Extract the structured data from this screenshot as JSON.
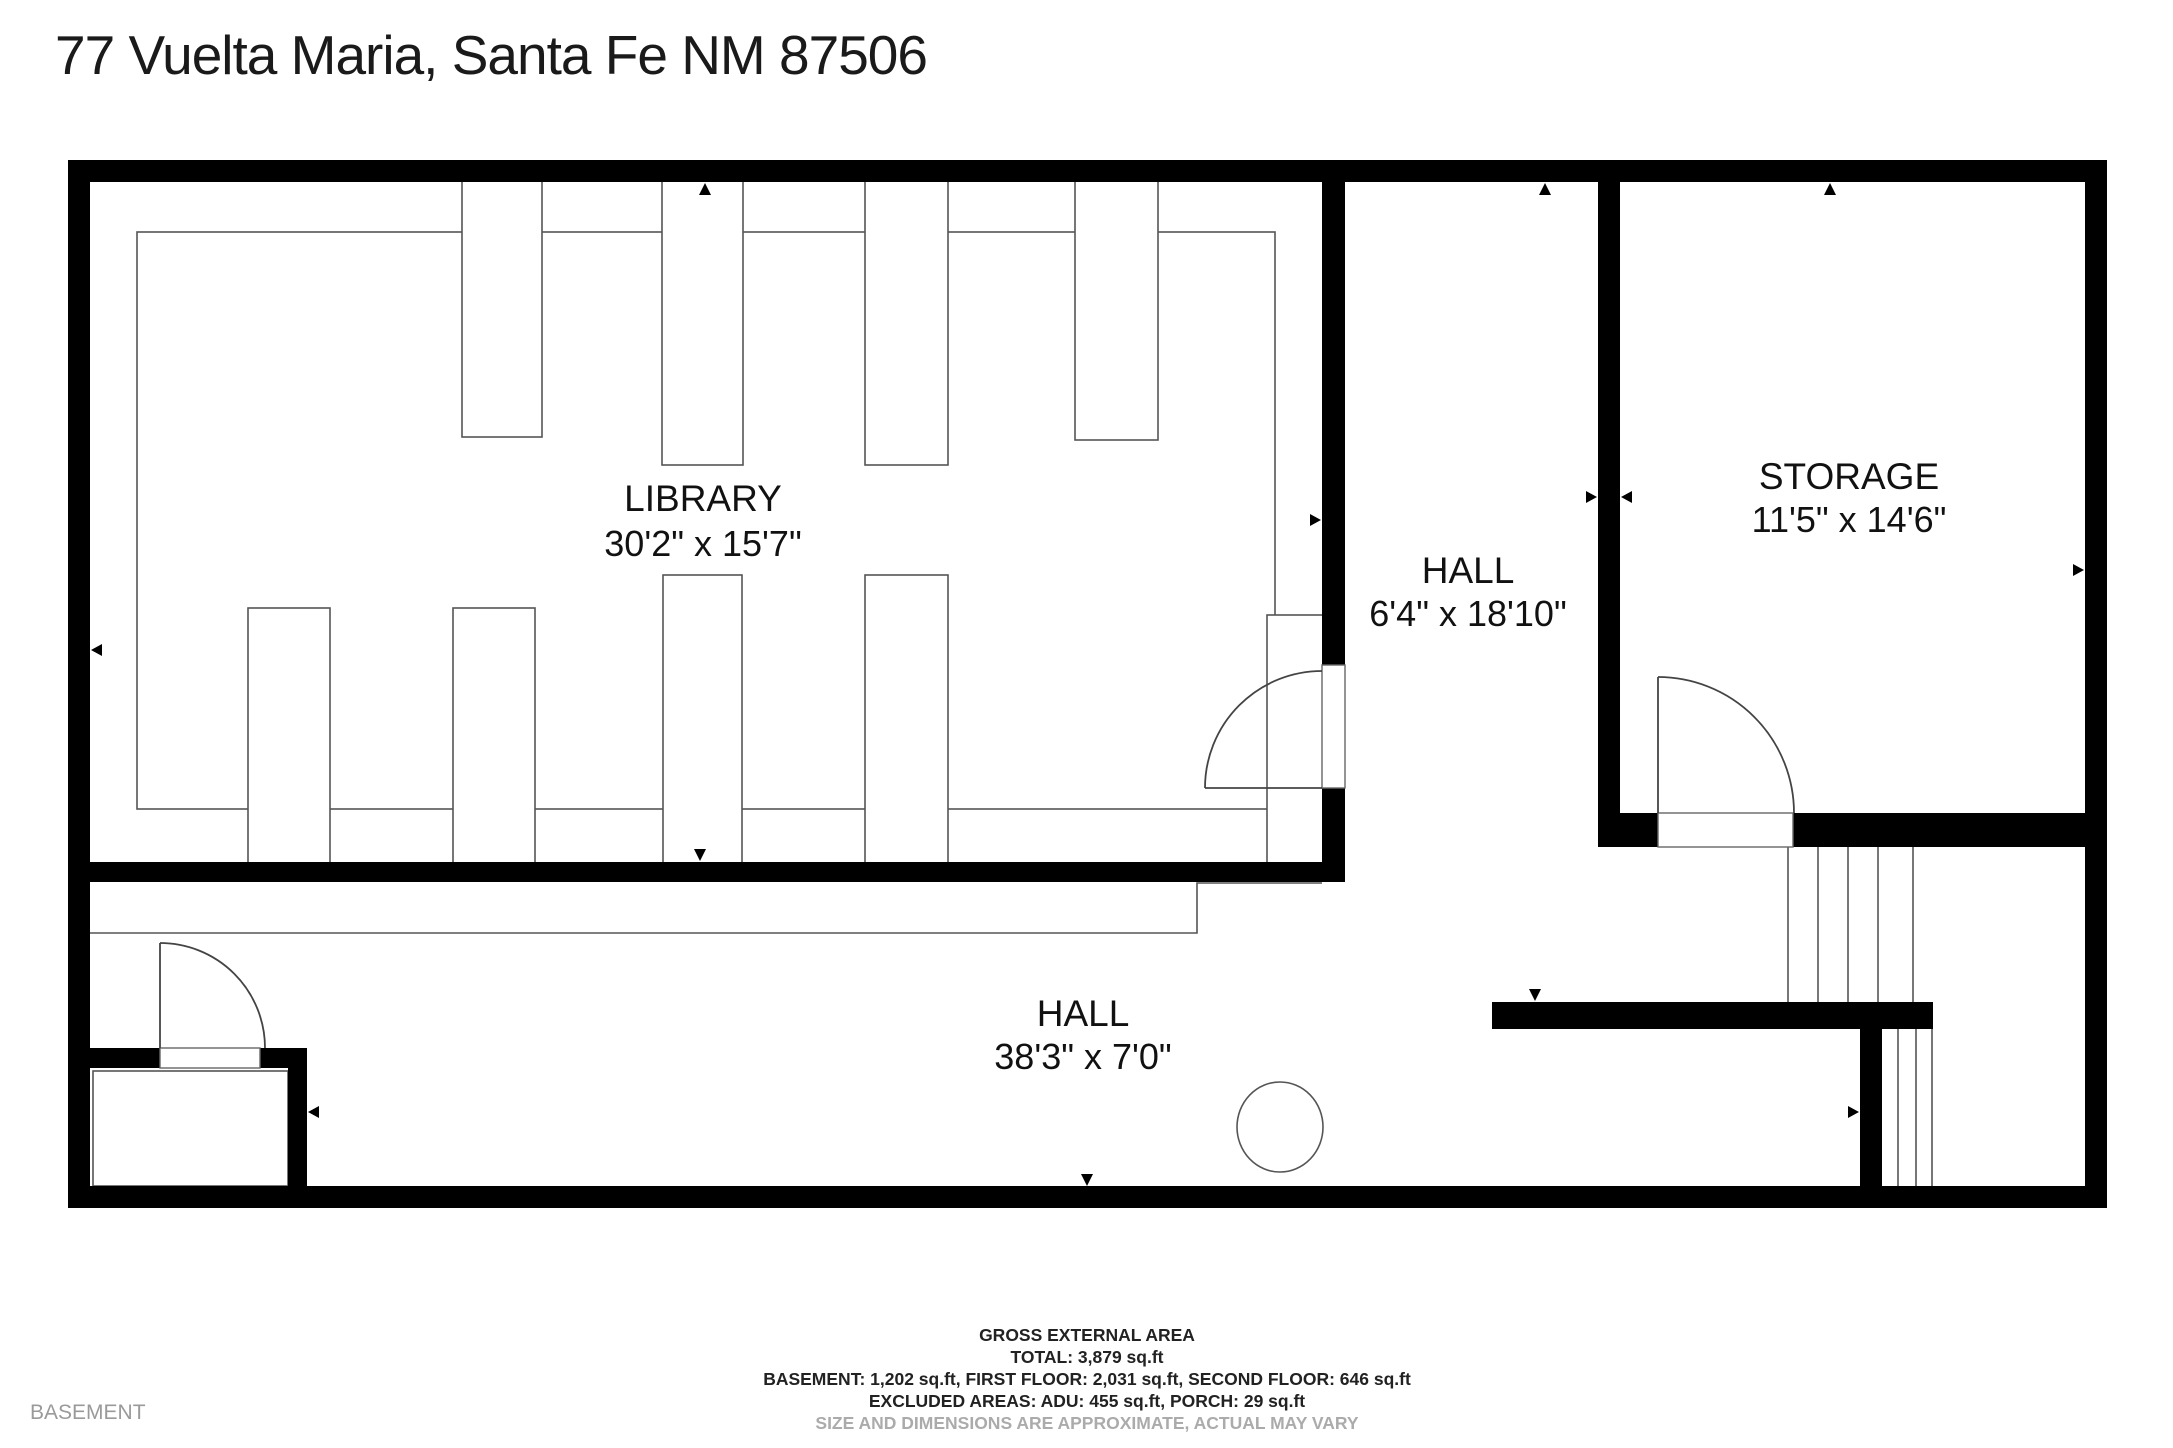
{
  "title": "77 Vuelta Maria, Santa Fe NM 87506",
  "floor_label": "BASEMENT",
  "rooms": {
    "library": {
      "name": "LIBRARY",
      "dims": "30'2\" x 15'7\""
    },
    "hall_upper": {
      "name": "HALL",
      "dims": "6'4\" x 18'10\""
    },
    "storage": {
      "name": "STORAGE",
      "dims": "11'5\" x 14'6\""
    },
    "hall_lower": {
      "name": "HALL",
      "dims": "38'3\" x 7'0\""
    }
  },
  "footer": {
    "heading": "GROSS EXTERNAL AREA",
    "total": "TOTAL: 3,879 sq.ft",
    "floors": "BASEMENT: 1,202 sq.ft, FIRST FLOOR: 2,031 sq.ft, SECOND FLOOR: 646 sq.ft",
    "excluded": "EXCLUDED AREAS: ADU: 455 sq.ft, PORCH: 29 sq.ft",
    "disclaimer": "SIZE AND DIMENSIONS ARE APPROXIMATE, ACTUAL MAY VARY"
  },
  "colors": {
    "wall": "#000000",
    "outline": "#555555",
    "text": "#111111",
    "muted": "#ababab"
  }
}
